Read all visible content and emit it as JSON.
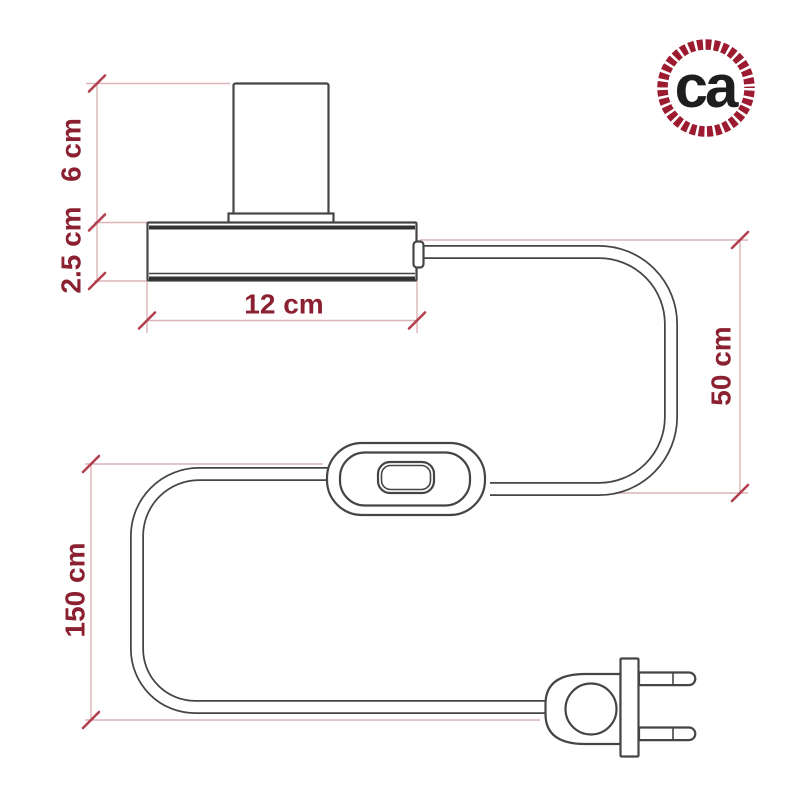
{
  "logo": {
    "text": "ca"
  },
  "dimensions": {
    "socket_height": "6 cm",
    "base_height": "2.5 cm",
    "base_width": "12 cm",
    "cable_upper_length": "50 cm",
    "cable_lower_length": "150 cm"
  },
  "colors": {
    "background": "#ffffff",
    "dimension_text": "#8b2130",
    "dimension_line": "#dcb3b7",
    "tick": "#b2404e",
    "ink": "#454545",
    "ink_strong": "#323232",
    "logo_ring": "#9c1b31",
    "logo_text": "#1e1e1e"
  }
}
